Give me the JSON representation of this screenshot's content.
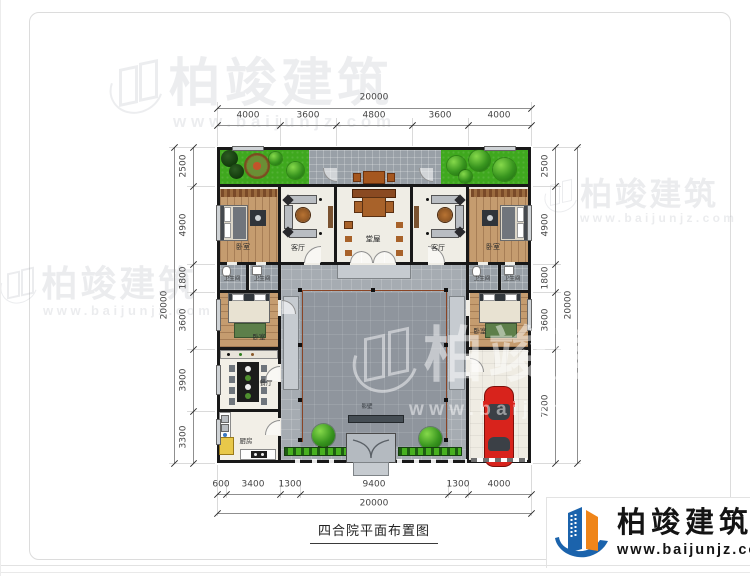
{
  "title": "四合院平面布置图",
  "logo": {
    "brand": "柏竣建筑",
    "url": "www.baijunjz.com"
  },
  "watermark": {
    "brand": "柏竣建筑",
    "url": "www.baijunjz.com"
  },
  "dimensions": {
    "top": {
      "total": "20000",
      "segments": [
        "4000",
        "3600",
        "4800",
        "3600",
        "4000"
      ]
    },
    "left": {
      "total": "20000",
      "segments": [
        "2500",
        "4900",
        "1800",
        "3600",
        "3900",
        "3300"
      ]
    },
    "right": {
      "total": "20000",
      "segments": [
        "2500",
        "4900",
        "1800",
        "3600",
        "7200"
      ]
    },
    "bottom": {
      "total": "20000",
      "segments": [
        "600",
        "3400",
        "1300",
        "9400",
        "1300",
        "4000"
      ]
    }
  },
  "rooms": {
    "bedroom": "卧室",
    "living": "客厅",
    "hall": "堂屋",
    "bathroom": "卫生间",
    "dining": "餐厅",
    "kitchen": "厨房",
    "screen_wall": "影壁"
  },
  "colors": {
    "wall": "#181818",
    "garden": "#3fa81e",
    "paving": "#9aa0a6",
    "wood": "#c59c6f",
    "car": "#d8231c",
    "logo_blue": "#1b63ac",
    "logo_orange": "#ef8519"
  }
}
